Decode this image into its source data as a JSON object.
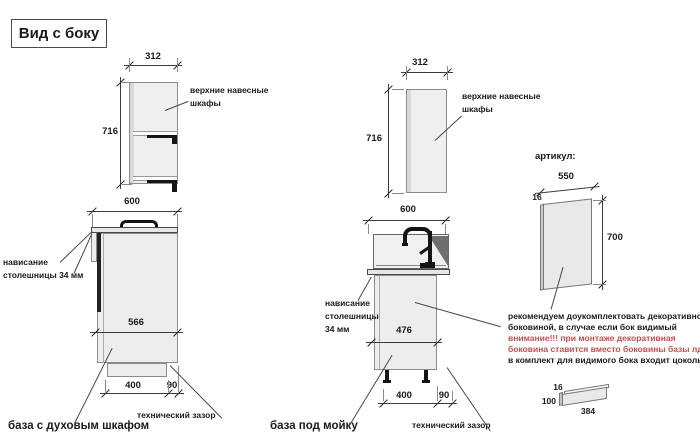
{
  "title": "Вид с боку",
  "colors": {
    "attention_red": "#c0504d",
    "cabinet_fill": "#ededed",
    "outline": "#8c8c8c",
    "dark_parts": "#151515"
  },
  "left_group": {
    "upper": {
      "width": "312",
      "height": "716",
      "label_line1": "верхние навесные",
      "label_line2": "шкафы"
    },
    "base": {
      "width": "600",
      "depth": "566",
      "plinth": "400",
      "gap": "90",
      "overhang_line1": "нависание",
      "overhang_line2": "столешницы 34 мм",
      "tech_gap": "технический зазор",
      "name": "база с духовым шкафом"
    }
  },
  "middle_group": {
    "upper": {
      "width": "312",
      "height": "716",
      "label_line1": "верхние навесные",
      "label_line2": "шкафы"
    },
    "base": {
      "width": "600",
      "depth": "476",
      "plinth": "400",
      "gap": "90",
      "overhang_line1": "нависание",
      "overhang_line2": "столешницы",
      "overhang_line3": "34 мм",
      "tech_gap": "технический зазор",
      "name": "база под мойку"
    }
  },
  "panel": {
    "heading": "артикул:",
    "width": "550",
    "thickness": "16",
    "height": "700"
  },
  "note": {
    "line1": "рекомендуем доукомплектовать декоративной",
    "line2": "боковиной, в случае если бок видимый",
    "line3": "внимание!!! при монтаже декоративная",
    "line4": "боковина ставится вместо боковины базы лдсп",
    "line5": "в комплект для видимого бока входит цоколь:"
  },
  "plinth_part": {
    "thickness": "16",
    "height": "100",
    "length": "384"
  }
}
